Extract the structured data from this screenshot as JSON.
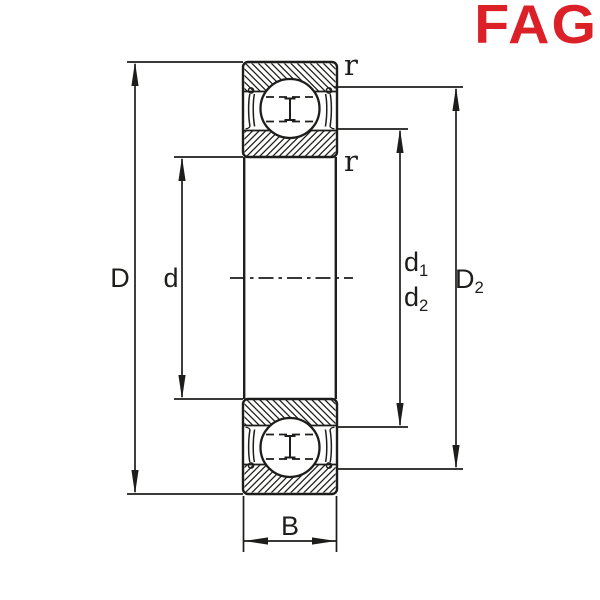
{
  "brand": {
    "name": "FAG",
    "color": "#dc2028"
  },
  "drawing": {
    "kind": "deep-groove-ball-bearing-cross-section",
    "line_color": "#1d1d1b",
    "labels": {
      "D": "D",
      "d": "d",
      "B": "B",
      "d1": {
        "base": "d",
        "sub": "1"
      },
      "d2": {
        "base": "d",
        "sub": "2"
      },
      "D2": {
        "base": "D",
        "sub": "2"
      },
      "r_top": "r",
      "r_bottom": "r"
    }
  }
}
